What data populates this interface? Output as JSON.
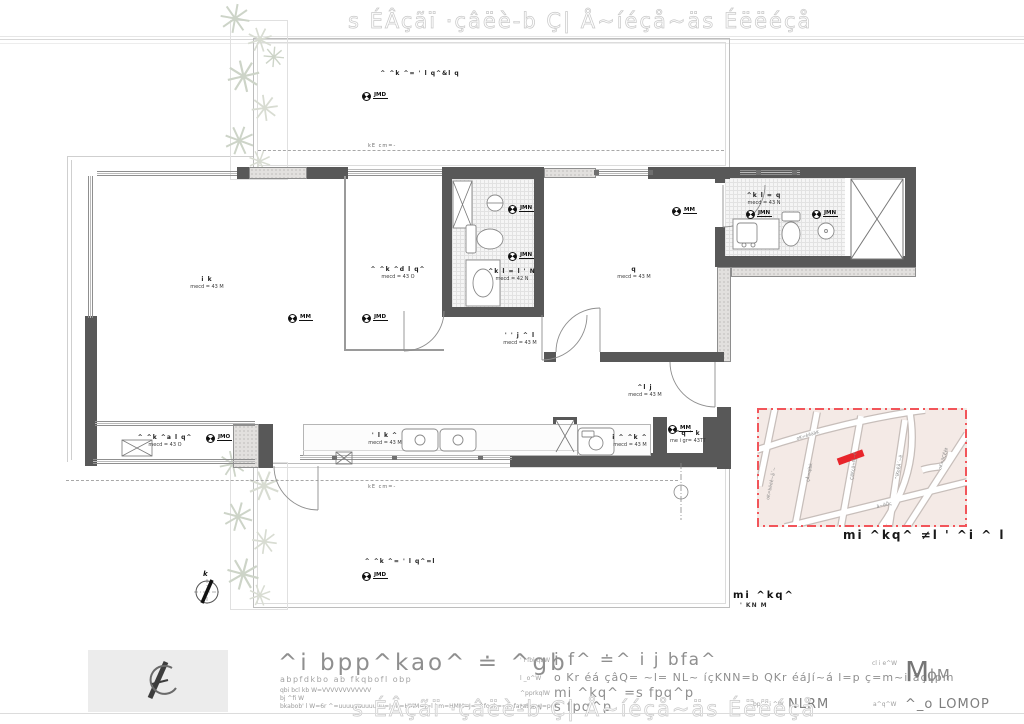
{
  "watermark": {
    "text": "s ÉÂçãï  ·çâëè-b Ç| Å~íéçå~äs Éëëéçå"
  },
  "plan": {
    "rooms": [
      {
        "name": "^  ^k ^=   ' l    q^&l   q",
        "area": ""
      },
      {
        "name": "i   k",
        "area": "mecd = 43 M"
      },
      {
        "name": "^ ^k ^d  l  q^",
        "area": "mecd = 43 O"
      },
      {
        "name": "^k  l = l ' N",
        "area": "mecd = 42 N"
      },
      {
        "name": "q",
        "area": "mecd = 43 M"
      },
      {
        "name": "^k  l =   q",
        "area": "mecd = 43 N"
      },
      {
        "name": "' ' j ^  l",
        "area": "mecd = 43 M"
      },
      {
        "name": "^l j",
        "area": "mecd = 43 M"
      },
      {
        "name": "' l  k ^",
        "area": "mecd = 43 M"
      },
      {
        "name": "i ^  ^k ^",
        "area": "mecd = 43 M"
      },
      {
        "name": "^q ' k",
        "area": "me i gr= 43TT"
      },
      {
        "name": "^ ^k ^a  l  q^",
        "area": "mecd = 43 O"
      },
      {
        "name": "^  ^k ^=   ' l   q^=l",
        "area": ""
      }
    ],
    "markers": [
      "JMD",
      "MM",
      "JMD",
      "JMN",
      "JMN",
      "MM",
      "JMN",
      "JMN",
      "JMO",
      "MM",
      "JMD"
    ],
    "setback_label": "kE  cm=-",
    "north_label": "k",
    "plan_tag": {
      "title": "mi ^kq^",
      "scale": "' KN  M"
    }
  },
  "site_map": {
    "caption": "mi ^kq^ ≠l ' ^i  ^     l",
    "streets": [
      "oK=bëéê~å´~",
      "çÅ=qîbk",
      "ÇêKçä=Ñ~ê",
      "^îKoÉÄ´~ë",
      "oK=ãÇÉëŧ",
      "oK=éêáãK",
      "ä~êÖç"
    ],
    "colors": {
      "bg": "#f4eae6",
      "border": "#f2555a",
      "site": "#e8252b",
      "street_edge": "#c7beba"
    }
  },
  "title_block": {
    "logo": "AC",
    "firm": "^i bpp^kao^ ≐ ^gb",
    "firm_sub": "abpfdkbo ab fkqbofl obp",
    "tel": "qbi bcl kb W=VVVVVVVVVVVV",
    "email": "bj ^fi W",
    "address": "bkabob' l W=6r ^=uuuuuuuuuuuu=J=k=HMM=J=l j m=HMM=J=_^fool ==J=fa*ab==J=pm",
    "client_label": "' i fbkqbW",
    "client": "i f^ ≐^ i j  bfa^",
    "obra_label": "l _o^W",
    "obra": "o Kr  éá  çâQ=  ~l=  NL~  íçKNN=b QKr  éáJí~á  l=p  ç=m~i äçLpm",
    "assunto_label": "^pprkqlW",
    "assunto": "mi ^kq^ =s fpq^p",
    "fase_label": "c^pbW",
    "fase": "s fpq^p",
    "folha_label": "cl i e^W",
    "folha_big": "M",
    "folha_small": "ϕM",
    "escala_label": "bp' ^i ^W",
    "escala": "NLRM",
    "data_label": "a^q^W",
    "data": "^_o LOMOP"
  }
}
